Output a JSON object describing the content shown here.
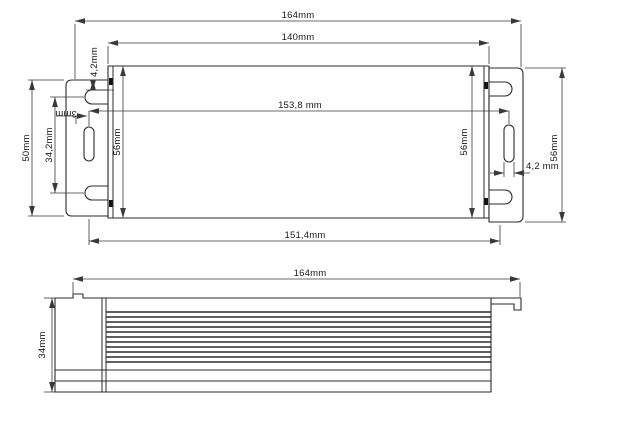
{
  "drawing": {
    "units": "mm",
    "colors": {
      "background": "#ffffff",
      "line": "#2b2b2b",
      "dimension_line": "#3a3a3a",
      "text": "#1a1a1a"
    },
    "plan_view": {
      "dim_overall_length": "164mm",
      "dim_body_length": "140mm",
      "dim_mount_hole_span": "153,8 mm",
      "dim_base_length": "151,4mm",
      "dim_left_flange_height": "50mm",
      "dim_left_slot_span": "34,2mm",
      "dim_left_notch_offset": "4,2mm",
      "dim_left_hole": "3mm",
      "dim_body_width_left": "56mm",
      "dim_body_width_right": "56mm",
      "dim_right_slot_width": "4,2 mm",
      "dim_right_flange_height": "56mm"
    },
    "side_view": {
      "dim_overall_length": "164mm",
      "dim_height": "34mm"
    }
  }
}
